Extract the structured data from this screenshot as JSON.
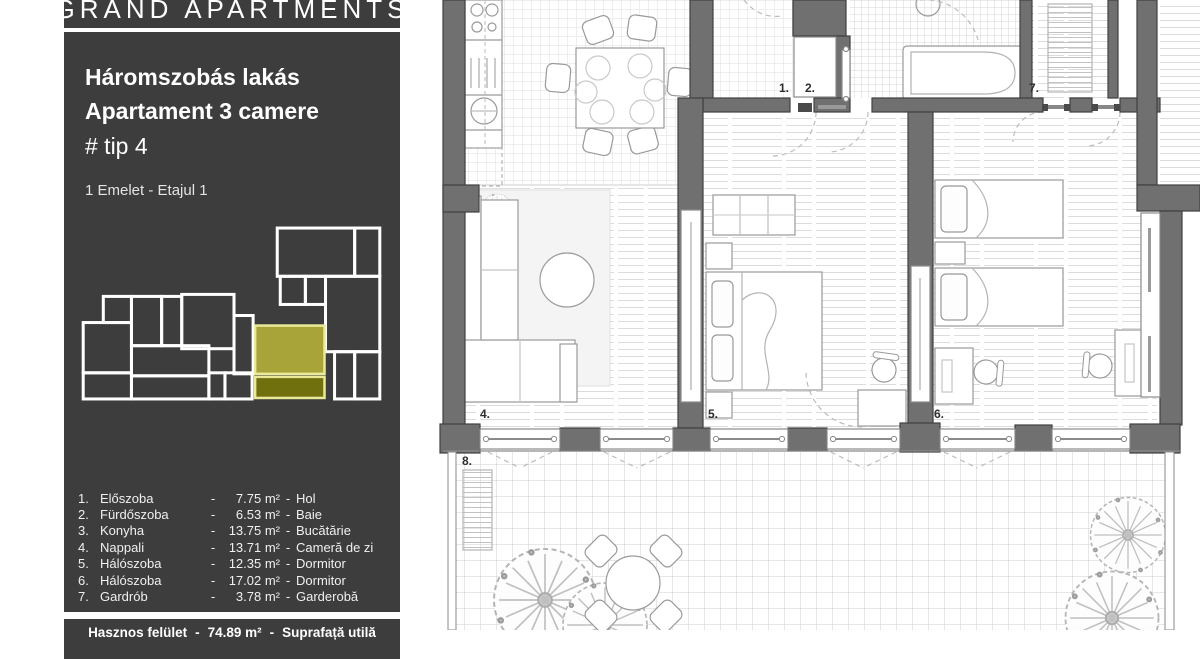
{
  "brand": {
    "name": "GRAND APARTMENTS"
  },
  "panel": {
    "title_hu": "Háromszobás lakás",
    "title_ro": "Apartament 3 camere",
    "type_line": "# tip 4",
    "floor_line": "1 Emelet - Etajul 1"
  },
  "colors": {
    "sidebar_bg": "#3d3d3d",
    "minimap_highlight": "#a9a43a",
    "minimap_highlight_dark": "#70700f",
    "wall_gray": "#707070"
  },
  "legend": {
    "dash": "-",
    "rows": [
      {
        "nr": "1.",
        "name_hu": "Előszoba",
        "area": "7.75 m²",
        "name_ro": "Hol"
      },
      {
        "nr": "2.",
        "name_hu": "Fürdőszoba",
        "area": "6.53 m²",
        "name_ro": "Baie"
      },
      {
        "nr": "3.",
        "name_hu": "Konyha",
        "area": "13.75 m²",
        "name_ro": "Bucătărie"
      },
      {
        "nr": "4.",
        "name_hu": "Nappali",
        "area": "13.71 m²",
        "name_ro": "Cameră de zi"
      },
      {
        "nr": "5.",
        "name_hu": "Hálószoba",
        "area": "12.35 m²",
        "name_ro": "Dormitor"
      },
      {
        "nr": "6.",
        "name_hu": "Hálószoba",
        "area": "17.02 m²",
        "name_ro": "Dormitor"
      },
      {
        "nr": "7.",
        "name_hu": "Gardrób",
        "area": "3.78 m²",
        "name_ro": "Garderobă"
      }
    ]
  },
  "total": {
    "label_hu": "Hasznos felület",
    "area": "74.89 m²",
    "label_ro": "Suprafață utilă"
  },
  "plan": {
    "room_labels": [
      {
        "id": "hall",
        "text": "1."
      },
      {
        "id": "bathroom",
        "text": "2."
      },
      {
        "id": "wardrobe",
        "text": "7."
      },
      {
        "id": "living-room",
        "text": "4."
      },
      {
        "id": "bedroom-1",
        "text": "5."
      },
      {
        "id": "bedroom-2",
        "text": "6."
      },
      {
        "id": "terrace",
        "text": "8."
      }
    ]
  }
}
